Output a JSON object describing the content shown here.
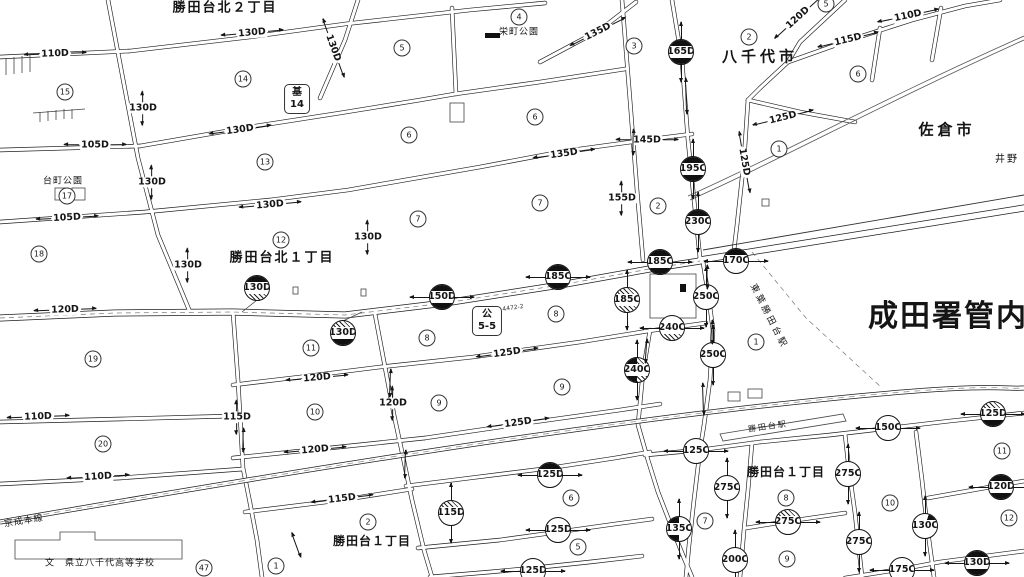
{
  "map_title": "路線価図 成田署管内 勝田台周辺",
  "colors": {
    "ink": "#1a1a1a",
    "background": "#ffffff",
    "boundary": "#555555"
  },
  "map": {
    "area_labels": [
      {
        "text": "勝田台北２丁目",
        "x": 225,
        "y": 8,
        "size": 13,
        "bold": true,
        "rot": 0,
        "spacing": 2
      },
      {
        "text": "栄町公園",
        "x": 519,
        "y": 33,
        "size": 9,
        "bold": false,
        "rot": 0,
        "spacing": 1
      },
      {
        "text": "八千代市",
        "x": 760,
        "y": 57,
        "size": 15,
        "bold": true,
        "rot": 0,
        "spacing": 4
      },
      {
        "text": "佐倉市",
        "x": 947,
        "y": 130,
        "size": 15,
        "bold": true,
        "rot": 0,
        "spacing": 4
      },
      {
        "text": "井野",
        "x": 1007,
        "y": 160,
        "size": 10,
        "bold": false,
        "rot": 0,
        "spacing": 2
      },
      {
        "text": "台町公園",
        "x": 63,
        "y": 182,
        "size": 9,
        "bold": false,
        "rot": 0,
        "spacing": 1
      },
      {
        "text": "勝田台北１丁目",
        "x": 282,
        "y": 258,
        "size": 13,
        "bold": true,
        "rot": 0,
        "spacing": 2
      },
      {
        "text": "成田署管内",
        "x": 948,
        "y": 317,
        "size": 30,
        "bold": true,
        "rot": 0,
        "spacing": 2
      },
      {
        "text": "東葉勝田台駅",
        "x": 768,
        "y": 317,
        "size": 9,
        "bold": false,
        "rot": 63,
        "spacing": 3
      },
      {
        "text": "勝田台駅",
        "x": 768,
        "y": 427,
        "size": 8,
        "bold": false,
        "rot": -8,
        "spacing": 2
      },
      {
        "text": "勝田台１丁目",
        "x": 786,
        "y": 472,
        "size": 12,
        "bold": true,
        "rot": 0,
        "spacing": 1
      },
      {
        "text": "勝田台１丁目",
        "x": 372,
        "y": 541,
        "size": 12,
        "bold": true,
        "rot": 0,
        "spacing": 1
      },
      {
        "text": "京成本線",
        "x": 24,
        "y": 522,
        "size": 9,
        "bold": false,
        "rot": -9,
        "spacing": 1
      },
      {
        "text": "文　県立八千代高等学校",
        "x": 100,
        "y": 564,
        "size": 9,
        "bold": false,
        "rot": 0,
        "spacing": 1
      }
    ],
    "value_labels": [
      {
        "text": "110D",
        "x": 55,
        "y": 54,
        "rot": -2,
        "dir": "h"
      },
      {
        "text": "130D",
        "x": 252,
        "y": 33,
        "rot": -5,
        "dir": "h"
      },
      {
        "text": "130D",
        "x": 143,
        "y": 108,
        "rot": 0,
        "dir": "v"
      },
      {
        "text": "105D",
        "x": 95,
        "y": 145,
        "rot": 0,
        "dir": "h"
      },
      {
        "text": "130D",
        "x": 240,
        "y": 130,
        "rot": -8,
        "dir": "h"
      },
      {
        "text": "130D",
        "x": 152,
        "y": 182,
        "rot": 0,
        "dir": "v"
      },
      {
        "text": "130D",
        "x": 333,
        "y": 48,
        "rot": 70,
        "dir": "h"
      },
      {
        "text": "105D",
        "x": 67,
        "y": 218,
        "rot": -3,
        "dir": "h"
      },
      {
        "text": "130D",
        "x": 270,
        "y": 205,
        "rot": -5,
        "dir": "h"
      },
      {
        "text": "130D",
        "x": 188,
        "y": 265,
        "rot": 0,
        "dir": "v"
      },
      {
        "text": "120D",
        "x": 65,
        "y": 310,
        "rot": -2,
        "dir": "h"
      },
      {
        "text": "135D",
        "x": 598,
        "y": 32,
        "rot": -27,
        "dir": "h"
      },
      {
        "text": "135D",
        "x": 564,
        "y": 154,
        "rot": -8,
        "dir": "h"
      },
      {
        "text": "145D",
        "x": 647,
        "y": 140,
        "rot": 0,
        "dir": "h"
      },
      {
        "text": "155D",
        "x": 622,
        "y": 198,
        "rot": 0,
        "dir": "v"
      },
      {
        "text": "130D",
        "x": 368,
        "y": 237,
        "rot": 0,
        "dir": "v"
      },
      {
        "text": "125D",
        "x": 507,
        "y": 353,
        "rot": -8,
        "dir": "h"
      },
      {
        "text": "120D",
        "x": 798,
        "y": 18,
        "rot": -42,
        "dir": "h"
      },
      {
        "text": "115D",
        "x": 848,
        "y": 40,
        "rot": -14,
        "dir": "h"
      },
      {
        "text": "110D",
        "x": 908,
        "y": 16,
        "rot": -12,
        "dir": "h"
      },
      {
        "text": "125D",
        "x": 783,
        "y": 118,
        "rot": -14,
        "dir": "h"
      },
      {
        "text": "125D",
        "x": 744,
        "y": 162,
        "rot": 80,
        "dir": "h"
      },
      {
        "text": "110D",
        "x": 38,
        "y": 417,
        "rot": -2,
        "dir": "h"
      },
      {
        "text": "110D",
        "x": 98,
        "y": 477,
        "rot": -3,
        "dir": "h"
      },
      {
        "text": "115D",
        "x": 237,
        "y": 417,
        "rot": 0,
        "dir": "v"
      },
      {
        "text": "120D",
        "x": 317,
        "y": 378,
        "rot": -5,
        "dir": "h"
      },
      {
        "text": "120D",
        "x": 315,
        "y": 450,
        "rot": -5,
        "dir": "h"
      },
      {
        "text": "120D",
        "x": 393,
        "y": 403,
        "rot": 0,
        "dir": "v"
      },
      {
        "text": "125D",
        "x": 518,
        "y": 423,
        "rot": -8,
        "dir": "h"
      },
      {
        "text": "115D",
        "x": 342,
        "y": 499,
        "rot": -7,
        "dir": "h"
      }
    ],
    "district_symbols": [
      {
        "text": "130D",
        "x": 257,
        "y": 288,
        "style": "black-hatch",
        "arr": ""
      },
      {
        "text": "130D",
        "x": 343,
        "y": 333,
        "style": "hatch-black",
        "arr": ""
      },
      {
        "text": "150D",
        "x": 442,
        "y": 297,
        "style": "black",
        "arr": "h"
      },
      {
        "text": "185C",
        "x": 558,
        "y": 277,
        "style": "black",
        "arr": "h"
      },
      {
        "text": "185C",
        "x": 660,
        "y": 262,
        "style": "black",
        "arr": "h"
      },
      {
        "text": "185C",
        "x": 627,
        "y": 300,
        "style": "hatch",
        "arr": "v"
      },
      {
        "text": "240C",
        "x": 672,
        "y": 328,
        "style": "white-hatch",
        "arr": "h"
      },
      {
        "text": "240C",
        "x": 637,
        "y": 370,
        "style": "lblack-rhatch",
        "arr": "v"
      },
      {
        "text": "250C",
        "x": 706,
        "y": 297,
        "style": "plain",
        "arr": "v"
      },
      {
        "text": "250C",
        "x": 713,
        "y": 355,
        "style": "plain",
        "arr": "v"
      },
      {
        "text": "165D",
        "x": 681,
        "y": 52,
        "style": "black",
        "arr": "v"
      },
      {
        "text": "195C",
        "x": 693,
        "y": 169,
        "style": "black",
        "arr": "v"
      },
      {
        "text": "230C",
        "x": 698,
        "y": 222,
        "style": "top-black",
        "arr": "v"
      },
      {
        "text": "170C",
        "x": 736,
        "y": 261,
        "style": "top-black",
        "arr": "h"
      },
      {
        "text": "125C",
        "x": 696,
        "y": 451,
        "style": "plain",
        "arr": "h"
      },
      {
        "text": "150C",
        "x": 888,
        "y": 428,
        "style": "plain",
        "arr": "h"
      },
      {
        "text": "125D",
        "x": 993,
        "y": 414,
        "style": "hatch-black",
        "arr": "h"
      },
      {
        "text": "120D",
        "x": 1001,
        "y": 487,
        "style": "black",
        "arr": "h"
      },
      {
        "text": "130D",
        "x": 977,
        "y": 563,
        "style": "black",
        "arr": "h"
      },
      {
        "text": "130C",
        "x": 925,
        "y": 526,
        "style": "wedge-tr",
        "arr": "v"
      },
      {
        "text": "135C",
        "x": 679,
        "y": 529,
        "style": "left-black",
        "arr": "v"
      },
      {
        "text": "275C",
        "x": 727,
        "y": 488,
        "style": "plain",
        "arr": "v"
      },
      {
        "text": "275C",
        "x": 788,
        "y": 522,
        "style": "top-hatch",
        "arr": "h"
      },
      {
        "text": "275C",
        "x": 848,
        "y": 474,
        "style": "plain",
        "arr": "v"
      },
      {
        "text": "275C",
        "x": 859,
        "y": 542,
        "style": "plain",
        "arr": "v"
      },
      {
        "text": "200C",
        "x": 735,
        "y": 560,
        "style": "plain",
        "arr": "v"
      },
      {
        "text": "175C",
        "x": 902,
        "y": 570,
        "style": "plain",
        "arr": "h"
      },
      {
        "text": "125D",
        "x": 550,
        "y": 475,
        "style": "top-black",
        "arr": "h"
      },
      {
        "text": "125D",
        "x": 558,
        "y": 530,
        "style": "plain",
        "arr": "h"
      },
      {
        "text": "125D",
        "x": 533,
        "y": 571,
        "style": "plain",
        "arr": "h"
      },
      {
        "text": "115D",
        "x": 451,
        "y": 513,
        "style": "top-hatch",
        "arr": "v"
      }
    ],
    "block_numbers": [
      {
        "n": "15",
        "x": 65,
        "y": 92
      },
      {
        "n": "14",
        "x": 243,
        "y": 79
      },
      {
        "n": "13",
        "x": 265,
        "y": 162
      },
      {
        "n": "17",
        "x": 67,
        "y": 196
      },
      {
        "n": "18",
        "x": 39,
        "y": 254
      },
      {
        "n": "12",
        "x": 281,
        "y": 240
      },
      {
        "n": "19",
        "x": 93,
        "y": 359
      },
      {
        "n": "11",
        "x": 311,
        "y": 348
      },
      {
        "n": "10",
        "x": 315,
        "y": 412
      },
      {
        "n": "20",
        "x": 103,
        "y": 444
      },
      {
        "n": "4",
        "x": 519,
        "y": 17
      },
      {
        "n": "5",
        "x": 402,
        "y": 48
      },
      {
        "n": "3",
        "x": 634,
        "y": 46
      },
      {
        "n": "6",
        "x": 409,
        "y": 135
      },
      {
        "n": "6",
        "x": 535,
        "y": 117
      },
      {
        "n": "7",
        "x": 418,
        "y": 219
      },
      {
        "n": "7",
        "x": 540,
        "y": 203
      },
      {
        "n": "2",
        "x": 658,
        "y": 206
      },
      {
        "n": "2",
        "x": 749,
        "y": 37
      },
      {
        "n": "5",
        "x": 826,
        "y": 4
      },
      {
        "n": "6",
        "x": 858,
        "y": 74
      },
      {
        "n": "1",
        "x": 779,
        "y": 149
      },
      {
        "n": "1",
        "x": 756,
        "y": 342
      },
      {
        "n": "8",
        "x": 427,
        "y": 338
      },
      {
        "n": "8",
        "x": 556,
        "y": 314
      },
      {
        "n": "9",
        "x": 439,
        "y": 403
      },
      {
        "n": "9",
        "x": 562,
        "y": 387
      },
      {
        "n": "2",
        "x": 368,
        "y": 522
      },
      {
        "n": "6",
        "x": 571,
        "y": 498
      },
      {
        "n": "5",
        "x": 578,
        "y": 547
      },
      {
        "n": "47",
        "x": 204,
        "y": 568
      },
      {
        "n": "1",
        "x": 276,
        "y": 566
      },
      {
        "n": "7",
        "x": 705,
        "y": 521
      },
      {
        "n": "8",
        "x": 786,
        "y": 498
      },
      {
        "n": "9",
        "x": 787,
        "y": 559
      },
      {
        "n": "10",
        "x": 890,
        "y": 503
      },
      {
        "n": "11",
        "x": 1002,
        "y": 451
      },
      {
        "n": "12",
        "x": 1009,
        "y": 518
      }
    ],
    "facility_boxes": [
      {
        "lines": [
          "基",
          "14"
        ],
        "x": 297,
        "y": 99
      },
      {
        "lines": [
          "公",
          "5-5"
        ],
        "x": 487,
        "y": 321
      }
    ],
    "tiny_labels": [
      {
        "text": "4472-2",
        "x": 513,
        "y": 308
      }
    ],
    "free_arrows": [
      {
        "x": 707,
        "y": 277,
        "rot": 90,
        "len": 24
      },
      {
        "x": 712,
        "y": 332,
        "rot": 90,
        "len": 24
      },
      {
        "x": 703,
        "y": 399,
        "rot": 88,
        "len": 32
      },
      {
        "x": 646,
        "y": 351,
        "rot": 94,
        "len": 24
      },
      {
        "x": 390,
        "y": 383,
        "rot": 92,
        "len": 28
      },
      {
        "x": 405,
        "y": 464,
        "rot": 92,
        "len": 28
      },
      {
        "x": 243,
        "y": 440,
        "rot": 91,
        "len": 24
      },
      {
        "x": 686,
        "y": 96,
        "rot": 88,
        "len": 36
      },
      {
        "x": 633,
        "y": 142,
        "rot": 91,
        "len": 26
      },
      {
        "x": 296,
        "y": 545,
        "rot": 70,
        "len": 26
      }
    ]
  }
}
